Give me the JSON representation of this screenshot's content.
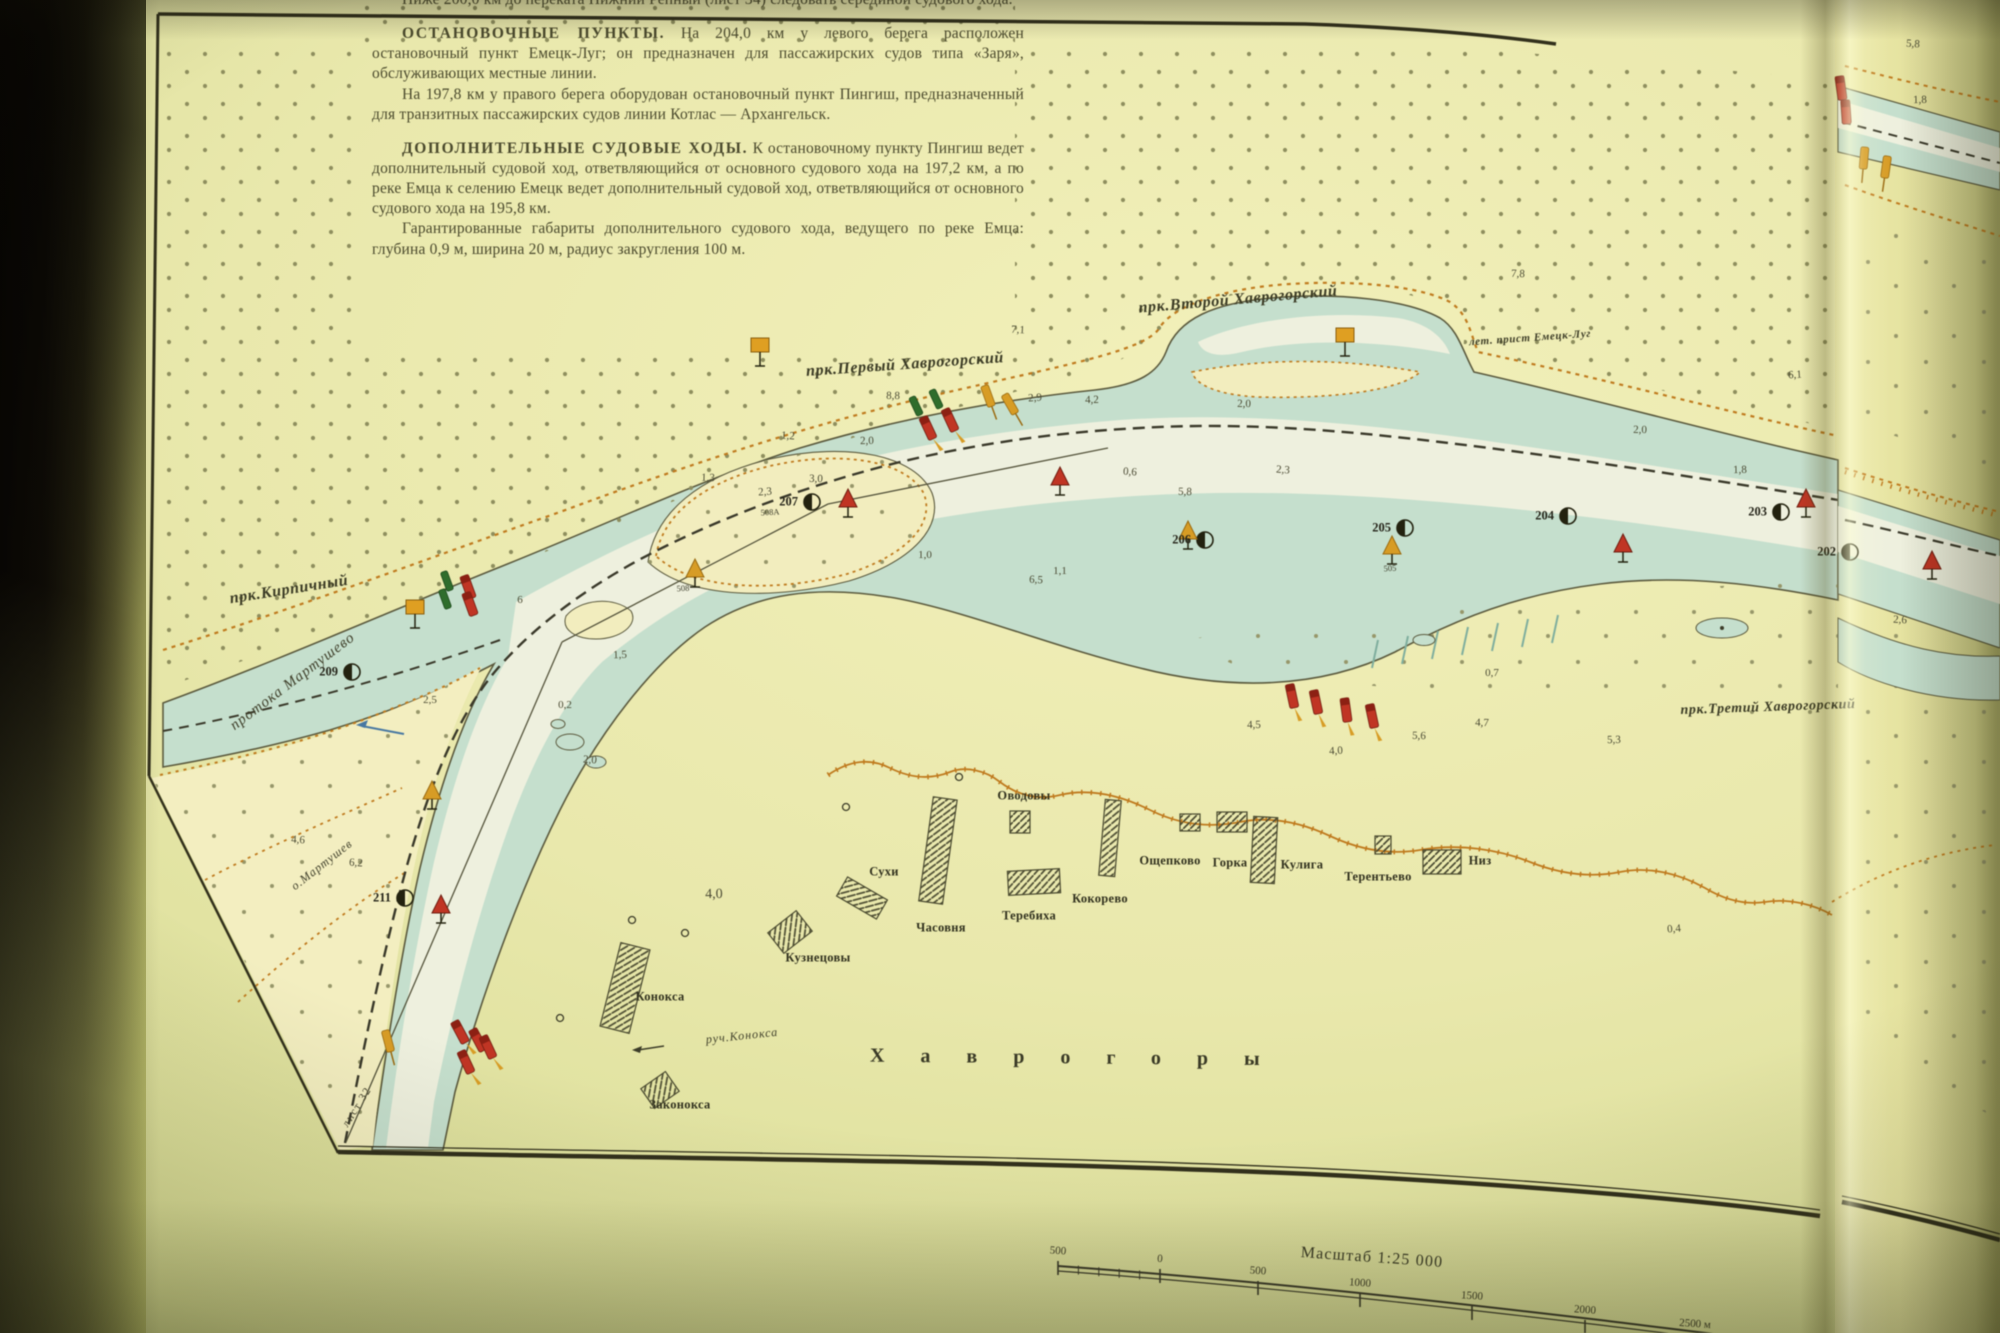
{
  "header_text": {
    "intro": "Ниже 200,0 км до переката Нижний Репный (лист 34) следовать серединой судового хода.",
    "stops_title": "ОСТАНОВОЧНЫЕ ПУНКТЫ.",
    "stops_body": " На 204,0 км у левого берега расположен остановочный пункт Емецк-Луг; он предназначен для пассажирских судов типа «Заря», обслуживающих местные линии.",
    "stops_body2": "На 197,8 км у правого берега оборудован остановочный пункт Пингиш, предназначенный для транзитных пассажирских судов линии Котлас — Архангельск.",
    "extra_title": "ДОПОЛНИТЕЛЬНЫЕ СУДОВЫЕ ХОДЫ.",
    "extra_body": " К остановочному пункту Пингиш ведет дополнительный судовой ход, ответвляющийся от основного судового хода на 197,2 км, а по реке Емца к селению Емецк ведет дополнительный судовой ход, ответвляющийся от основного судового хода на 195,8 км.",
    "extra_body2": "Гарантированные габариты дополнительного судового хода, ведущего по реке Емца: глубина 0,9 м, ширина 20 м, радиус закругления 100 м."
  },
  "map": {
    "reaches": [
      {
        "text": "прк.Первый Хаврогорский",
        "x": 905,
        "y": 365,
        "rot": -4,
        "s": 16
      },
      {
        "text": "прк.Второй Хаврогорский",
        "x": 1238,
        "y": 300,
        "rot": -5,
        "s": 16
      },
      {
        "text": "прк.Третий Хаврогорский",
        "x": 1768,
        "y": 708,
        "rot": -2,
        "s": 14
      },
      {
        "text": "прк.Кирпичный",
        "x": 289,
        "y": 590,
        "rot": -9,
        "s": 16
      },
      {
        "text": "лет. прист Емецк-Луг",
        "x": 1530,
        "y": 338,
        "rot": -4,
        "s": 11
      }
    ],
    "waters": [
      {
        "text": "протока Мартушево",
        "x": 293,
        "y": 682,
        "rot": -37,
        "s": 15
      },
      {
        "text": "о.Мартушев",
        "x": 322,
        "y": 865,
        "rot": -38,
        "s": 12
      },
      {
        "text": "руч.Конокса",
        "x": 742,
        "y": 1036,
        "rot": -6,
        "s": 12
      }
    ],
    "villages": [
      {
        "text": "Сухи",
        "x": 884,
        "y": 872
      },
      {
        "text": "Часовня",
        "x": 941,
        "y": 928
      },
      {
        "text": "Оводовы",
        "x": 1024,
        "y": 796
      },
      {
        "text": "Теребиха",
        "x": 1029,
        "y": 916
      },
      {
        "text": "Кокорево",
        "x": 1100,
        "y": 899
      },
      {
        "text": "Ощепково",
        "x": 1170,
        "y": 861
      },
      {
        "text": "Горка",
        "x": 1230,
        "y": 863
      },
      {
        "text": "Кулига",
        "x": 1302,
        "y": 865
      },
      {
        "text": "Терентьево",
        "x": 1378,
        "y": 877
      },
      {
        "text": "Низ",
        "x": 1480,
        "y": 861
      },
      {
        "text": "Кузнецовы",
        "x": 818,
        "y": 958
      },
      {
        "text": "Конокса",
        "x": 660,
        "y": 997
      },
      {
        "text": "Законокса",
        "x": 680,
        "y": 1105
      }
    ],
    "area_title": {
      "text": "Хаврогоры",
      "x": 870,
      "y": 1058
    },
    "sheet_ref": {
      "text": "лист 32",
      "x": 357,
      "y": 1107,
      "rot": -58
    },
    "km_marks": [
      [
        "202",
        1850,
        552
      ],
      [
        "203",
        1781,
        512
      ],
      [
        "204",
        1568,
        516
      ],
      [
        "205",
        1405,
        528
      ],
      [
        "206",
        1205,
        540
      ],
      [
        "207",
        812,
        502
      ],
      [
        "209",
        352,
        672
      ],
      [
        "211",
        405,
        898
      ]
    ],
    "buoy_nums": [
      {
        "t": "508",
        "x": 683,
        "y": 588
      },
      {
        "t": "508А",
        "x": 770,
        "y": 512
      },
      {
        "t": "505",
        "x": 1390,
        "y": 568
      }
    ],
    "depths": [
      [
        788,
        436,
        "1,2"
      ],
      [
        867,
        441,
        "2,0"
      ],
      [
        708,
        478,
        "1,3"
      ],
      [
        765,
        492,
        "2,3"
      ],
      [
        816,
        479,
        "3,0"
      ],
      [
        1018,
        330,
        "7,1"
      ],
      [
        893,
        396,
        "8,8"
      ],
      [
        1035,
        398,
        "2,9"
      ],
      [
        1092,
        400,
        "4,2"
      ],
      [
        1244,
        404,
        "2,0"
      ],
      [
        1130,
        472,
        "0,6"
      ],
      [
        1185,
        492,
        "5,8"
      ],
      [
        1283,
        470,
        "2,3"
      ],
      [
        1492,
        673,
        "0,7"
      ],
      [
        1482,
        723,
        "4,7"
      ],
      [
        1419,
        736,
        "5,6"
      ],
      [
        1336,
        751,
        "4,0"
      ],
      [
        1254,
        725,
        "4,5"
      ],
      [
        1614,
        740,
        "5,3"
      ],
      [
        1036,
        580,
        "6,5"
      ],
      [
        925,
        555,
        "1,0"
      ],
      [
        1060,
        571,
        "1,1"
      ],
      [
        620,
        655,
        "1,5"
      ],
      [
        565,
        705,
        "0,2"
      ],
      [
        590,
        760,
        "2,0"
      ],
      [
        298,
        840,
        "4,6"
      ],
      [
        356,
        863,
        "6,2"
      ],
      [
        714,
        895,
        "4,0",
        14
      ],
      [
        1518,
        274,
        "7,8"
      ],
      [
        1795,
        375,
        "6,1"
      ],
      [
        1674,
        929,
        "0,4"
      ],
      [
        1740,
        470,
        "1,8"
      ],
      [
        1640,
        430,
        "2,0"
      ],
      [
        1913,
        44,
        "5,8"
      ],
      [
        1920,
        100,
        "1,8"
      ],
      [
        520,
        600,
        "6"
      ],
      [
        430,
        700,
        "2,5"
      ],
      [
        1900,
        620,
        "2,6"
      ]
    ],
    "buoys": [
      [
        "spar_green",
        916,
        406,
        -25,
        0
      ],
      [
        "spar_green",
        936,
        399,
        -25,
        0
      ],
      [
        "spar_red",
        928,
        428,
        -25,
        1
      ],
      [
        "spar_red",
        950,
        420,
        -25,
        1
      ],
      [
        "spar_yellow",
        988,
        396,
        -20,
        0
      ],
      [
        "spar_yellow",
        1010,
        404,
        -30,
        0
      ],
      [
        "spar_green",
        447,
        581,
        -20,
        0
      ],
      [
        "spar_green",
        445,
        599,
        -20,
        0
      ],
      [
        "spar_red",
        468,
        587,
        -20,
        0
      ],
      [
        "spar_red",
        470,
        604,
        -20,
        0
      ],
      [
        "spar_red",
        1292,
        696,
        -12,
        1
      ],
      [
        "spar_red",
        1316,
        702,
        -12,
        1
      ],
      [
        "spar_red",
        1346,
        710,
        -8,
        1
      ],
      [
        "spar_red",
        1372,
        716,
        -12,
        1
      ],
      [
        "spar_red",
        460,
        1032,
        -28,
        1
      ],
      [
        "spar_red",
        478,
        1040,
        -28,
        0
      ],
      [
        "spar_red",
        466,
        1062,
        -25,
        1
      ],
      [
        "spar_red",
        488,
        1047,
        -25,
        1
      ],
      [
        "spar_yellow",
        388,
        1041,
        -15,
        0
      ],
      [
        "tri_yellow",
        695,
        570,
        0,
        0
      ],
      [
        "tri_yellow",
        1188,
        532,
        0,
        0
      ],
      [
        "tri_yellow",
        1392,
        547,
        0,
        0
      ],
      [
        "tri_yellow",
        432,
        792,
        0,
        0
      ],
      [
        "tri_red",
        848,
        500,
        0,
        0
      ],
      [
        "tri_red",
        1060,
        478,
        0,
        0
      ],
      [
        "tri_red",
        1623,
        545,
        0,
        0
      ],
      [
        "tri_red",
        1806,
        500,
        0,
        0
      ],
      [
        "tri_red",
        1932,
        562,
        0,
        0
      ],
      [
        "tri_red",
        441,
        906,
        0,
        0
      ],
      [
        "sign",
        760,
        345,
        0,
        0
      ],
      [
        "sign",
        1345,
        335,
        0,
        0
      ],
      [
        "sign",
        415,
        607,
        0,
        0
      ],
      [
        "spar_red",
        1841,
        88,
        -8,
        0
      ],
      [
        "spar_red",
        1846,
        112,
        -4,
        0
      ],
      [
        "spar_yellow",
        1864,
        158,
        5,
        0
      ],
      [
        "spar_yellow",
        1886,
        167,
        8,
        0
      ]
    ],
    "scale_bar": {
      "title": "Масштаб 1:25 000",
      "ticks": [
        "500",
        "0",
        "500",
        "1000",
        "1500",
        "2000",
        "2500 м"
      ],
      "tick_points": [
        [
          1058,
          1266
        ],
        [
          1160,
          1274
        ],
        [
          1258,
          1286
        ],
        [
          1360,
          1298
        ],
        [
          1472,
          1311
        ],
        [
          1585,
          1325
        ],
        [
          1695,
          1339
        ]
      ]
    }
  }
}
